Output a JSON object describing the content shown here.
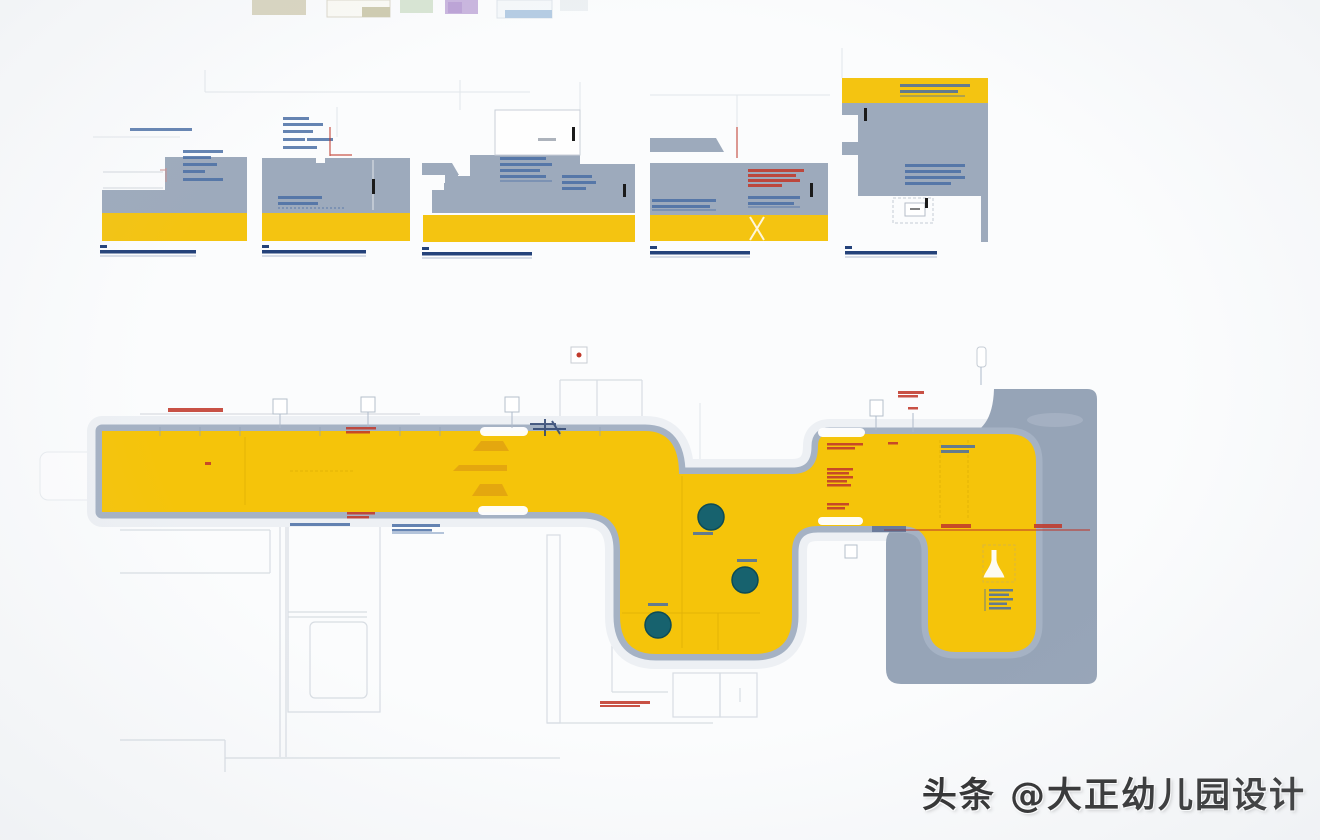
{
  "watermark": {
    "text": "头条 @大正幼儿园设计"
  },
  "colors": {
    "plan-yellow": "#F5C40A",
    "plan-gray": "#96A4B7",
    "plan-stroke": "#A5B2C4",
    "section-gray": "#9DAABC",
    "section-yellow": "#F4C411",
    "tree-teal": "#17626E",
    "annotation-red": "#C0392B",
    "annotation-blue": "#4A6FA5",
    "caption-navy": "#24427A",
    "faint-line": "#D8DDE3",
    "hatch-orange": "#DE9B12"
  },
  "plan": {
    "trees": [
      {
        "x": 711,
        "y": 517
      },
      {
        "x": 745,
        "y": 580
      },
      {
        "x": 658,
        "y": 625
      }
    ],
    "tree_radius": 13
  },
  "sections": {
    "count": 5,
    "ids": [
      "section-detail-1",
      "section-detail-2",
      "section-detail-3",
      "section-detail-4",
      "section-detail-5"
    ]
  }
}
